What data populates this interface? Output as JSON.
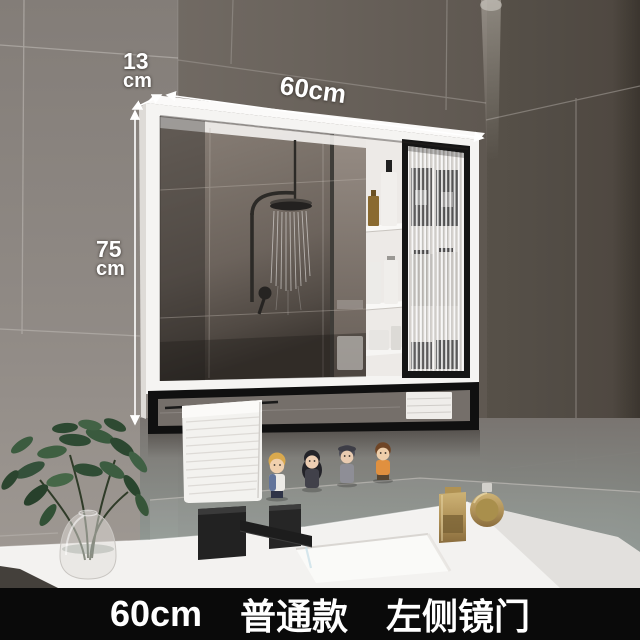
{
  "caption": {
    "size": "60cm",
    "variant": "普通款",
    "door_side": "左侧镜门"
  },
  "dimensions": {
    "depth_value": "13",
    "depth_unit": "cm",
    "width_label": "60cm",
    "height_value": "75",
    "height_unit": "cm"
  },
  "palette": {
    "caption_background": "#0a0a0a",
    "caption_text": "#ffffff",
    "annotation_text": "#ffffff",
    "wall_left": "#8d8782",
    "wall_back": "#675f59",
    "wall_right": "#565049",
    "cabinet_frame": "#f5f4f2",
    "open_shelf_frame": "#141414",
    "fluted_glass": "#d8d5d1",
    "countertop": "#f3f2f0",
    "towel": "#f3f2ef",
    "plant_green": "#3c5a3e",
    "perfume_gold": "#b69a5c",
    "faucet_black": "#1f1f1f"
  }
}
